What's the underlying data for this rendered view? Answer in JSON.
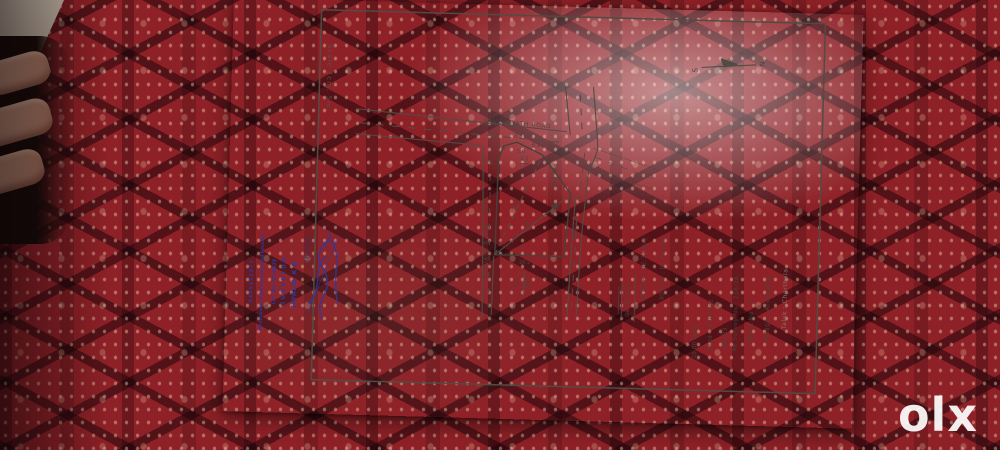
{
  "watermark": {
    "brand": "olx"
  },
  "document": {
    "scale_note": "Scale 1cm: 5m.",
    "north": {
      "n": "N",
      "s": "S"
    },
    "roads": {
      "panchayath": "PANCHAYATH ROAD",
      "private": "PRIVATE ROAD"
    },
    "title_block": {
      "taluk": "Taluk : Cherthala",
      "village": "Village : Arookutty",
      "block": "Block No : 5",
      "resurvey": "Re.Survey No : 218/2A,",
      "resurvey2": "907/23",
      "area": "Area : 4.05 Are",
      "area_cents": "(10.00 Cent)"
    },
    "area_list": {
      "line1": "907/23 : 01.71 Are",
      "line2": "218/2A : 02.34 Are",
      "total": "04.05 Are"
    },
    "parcel_label": {
      "numerator": "907",
      "denominator": "23"
    },
    "dimensions": {
      "west": "24.0",
      "left_out": "5.5",
      "jog": "1.5",
      "seg1": "3.3",
      "seg2": "6.2",
      "inner1": "5.8",
      "inner2": "5.5",
      "ne1": "8.3",
      "ne2": "14.0",
      "east": "16.5",
      "south": "16.2",
      "diag_dashed": "27.3",
      "diag_solid": "24"
    },
    "stamp": {
      "name": "JAYALAL K.R.",
      "role": "SURVEYOR",
      "lic": "Lic. No. 97/2022",
      "dept": "Directorate of Survey and Land Records",
      "phone": "9495252873",
      "date": "16-2-24"
    }
  }
}
